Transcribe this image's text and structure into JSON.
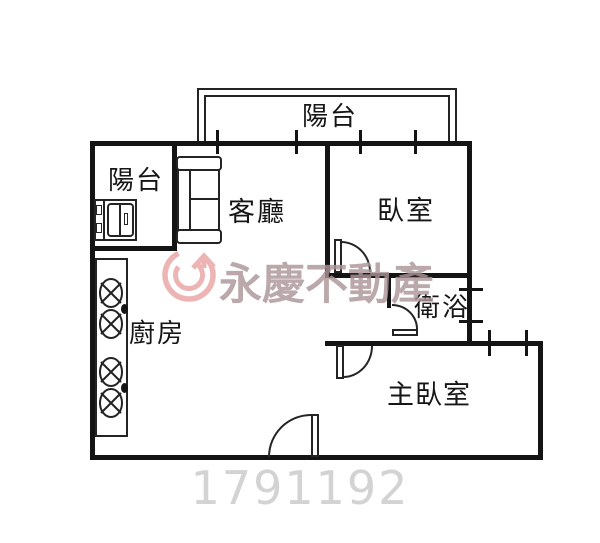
{
  "document": {
    "type": "real-estate floor plan"
  },
  "rooms": [
    {
      "name": "balcony-top",
      "label": "陽台"
    },
    {
      "name": "balcony-left",
      "label": "陽台"
    },
    {
      "name": "living-room",
      "label": "客廳"
    },
    {
      "name": "bedroom",
      "label": "臥室"
    },
    {
      "name": "bathroom",
      "label": "衛浴"
    },
    {
      "name": "master-bedroom",
      "label": "主臥室"
    },
    {
      "name": "kitchen",
      "label": "廚房"
    }
  ],
  "watermark": {
    "brand_text": "永慶不動產",
    "logo": "yungching-circle-arrow-logo",
    "logo_color": "#e9a2a2",
    "text_color": "#ac9598"
  },
  "photo_id": {
    "value": "1791192",
    "color": "#d3d3d3"
  },
  "colors": {
    "background": "#ffffff",
    "wall": "#141414",
    "thin_line": "#242424"
  }
}
